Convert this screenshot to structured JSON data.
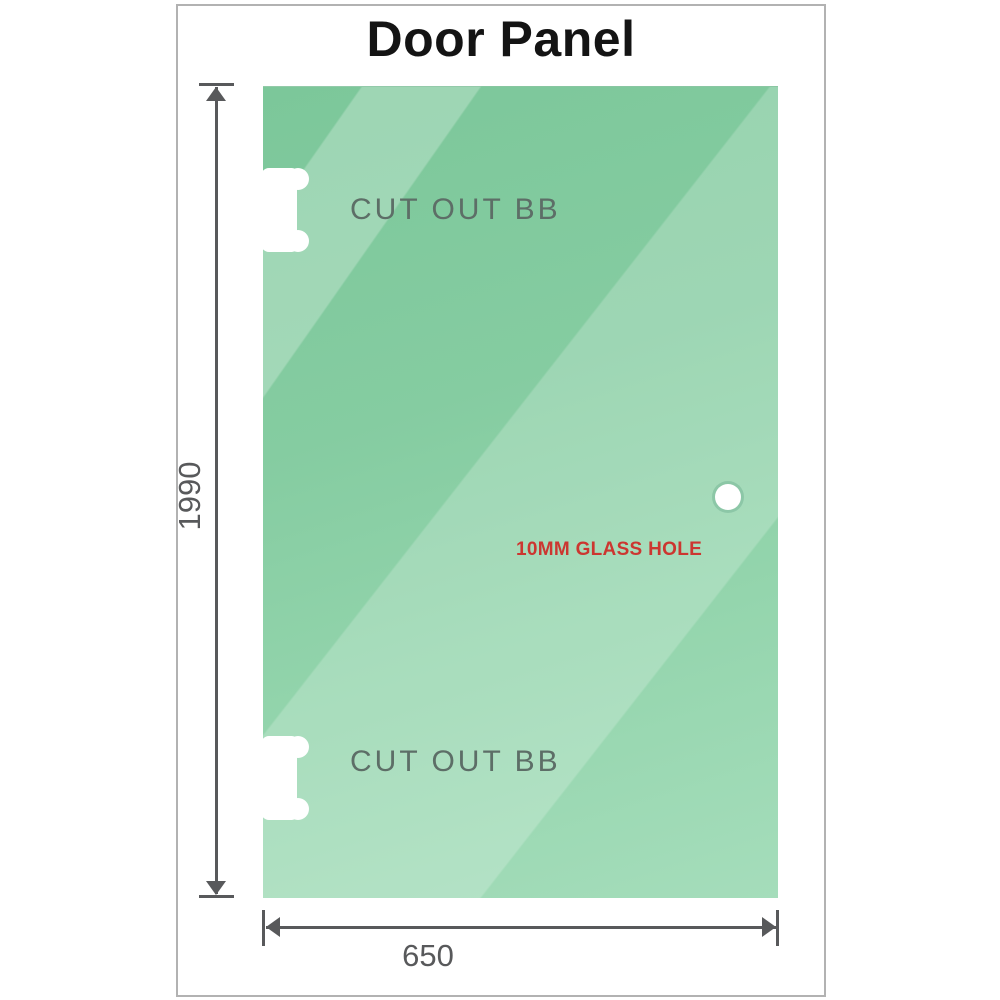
{
  "title": "Door Panel",
  "panel": {
    "cutouts": [
      {
        "label": "CUT OUT BB"
      },
      {
        "label": "CUT OUT BB"
      }
    ],
    "glass_hole": {
      "label": "10MM GLASS HOLE"
    }
  },
  "dimensions": {
    "height": {
      "value": "1990"
    },
    "width": {
      "value": "650"
    }
  },
  "colors": {
    "glass_green_top": "#7cc79a",
    "glass_green_bottom": "#a5ddbb",
    "hole_label_red": "#cc3630",
    "dimension_gray": "#58595b",
    "cutout_label_gray": "#5d6e67",
    "frame_border_gray": "#b2b2b2",
    "title_black": "#141414"
  },
  "icons": {
    "hinge_cutout": "white notched hinge cut-out shape",
    "glass_hole": "white circle",
    "dimension_arrows": "filled triangle arrowheads with end caps"
  }
}
